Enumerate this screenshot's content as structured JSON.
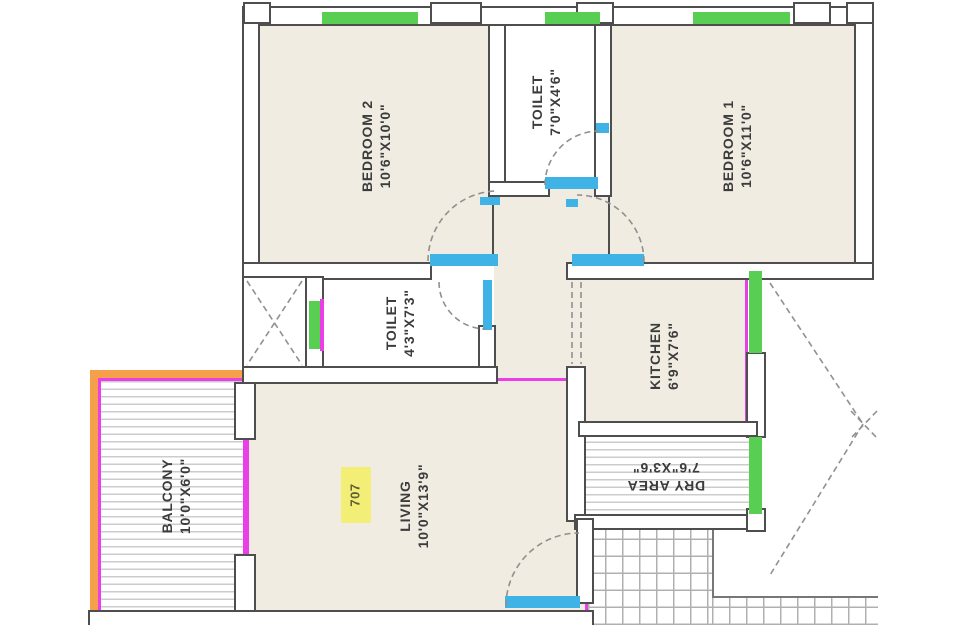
{
  "plan": {
    "title": "apartment-floor-plan",
    "unit": {
      "number": "707"
    },
    "rooms": [
      {
        "name": "BEDROOM 2",
        "dimensions": "10'6\"X10'0\""
      },
      {
        "name": "TOILET",
        "dimensions": "7'0\"X4'6\""
      },
      {
        "name": "BEDROOM 1",
        "dimensions": "10'6\"X11'0\""
      },
      {
        "name": "TOILET",
        "dimensions": "4'3\"X7'3\""
      },
      {
        "name": "KITCHEN",
        "dimensions": "6'9\"X7'6\""
      },
      {
        "name": "DRY AREA",
        "dimensions": "7'6\"X3'6\""
      },
      {
        "name": "LIVING",
        "dimensions": "10'0\"X13'9\""
      },
      {
        "name": "BALCONY",
        "dimensions": "10'0\"X6'0\""
      }
    ],
    "colors": {
      "wall": "#4e4e4e",
      "inner_finish_magenta": "#ea3fe8",
      "window_green": "#58cf52",
      "door_sill_blue": "#3fb3e6",
      "balcony_edge_orange": "#f6a04b",
      "unit_highlight_yellow": "#f2ee76",
      "room_fill": "#f0ece2"
    }
  }
}
